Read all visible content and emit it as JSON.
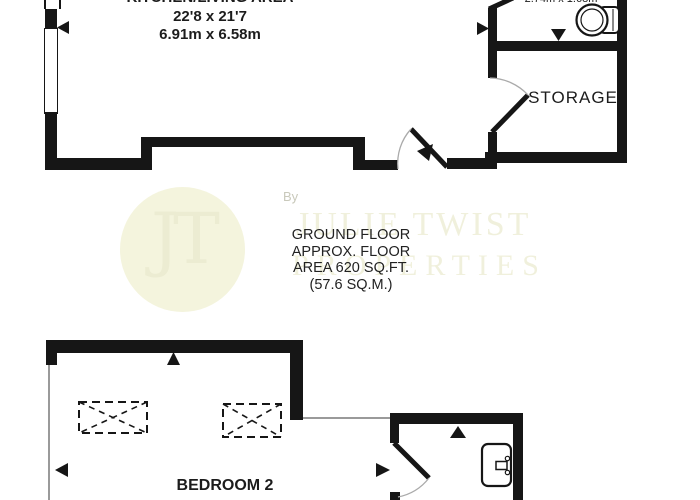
{
  "plan": {
    "title_note": "floorplan",
    "rooms": {
      "kitchen_living": {
        "label_partial": "KITCHEN/LIVING AREA",
        "dims_imperial": "22'8 x 21'7",
        "dims_metric": "6.91m x 6.58m"
      },
      "shower_room": {
        "dims_partial": "2.74m x 1.68m"
      },
      "storage": {
        "label": "STORAGE"
      },
      "bedroom2": {
        "label": "BEDROOM 2"
      }
    },
    "floor_info": {
      "line1": "GROUND FLOOR",
      "line2": "APPROX. FLOOR",
      "line3": "AREA 620 SQ.FT.",
      "line4": "(57.6 SQ.M.)"
    },
    "watermark": {
      "by": "By",
      "monogram": "JT",
      "name_line1": "JULIE TWIST",
      "name_line2": "PROPERTIES",
      "circle_color": "#f4f4dd",
      "text_color": "#f0f0dc"
    },
    "colors": {
      "wall": "#161616",
      "background": "#ffffff",
      "thin_line": "#9a9a9a",
      "arc_line": "#aaaaaa"
    },
    "icons": {
      "toilet": "toilet-icon",
      "sink": "sink-icon",
      "skylight": "skylight-hatch-icon",
      "marker": "arrow-marker-icon"
    }
  }
}
